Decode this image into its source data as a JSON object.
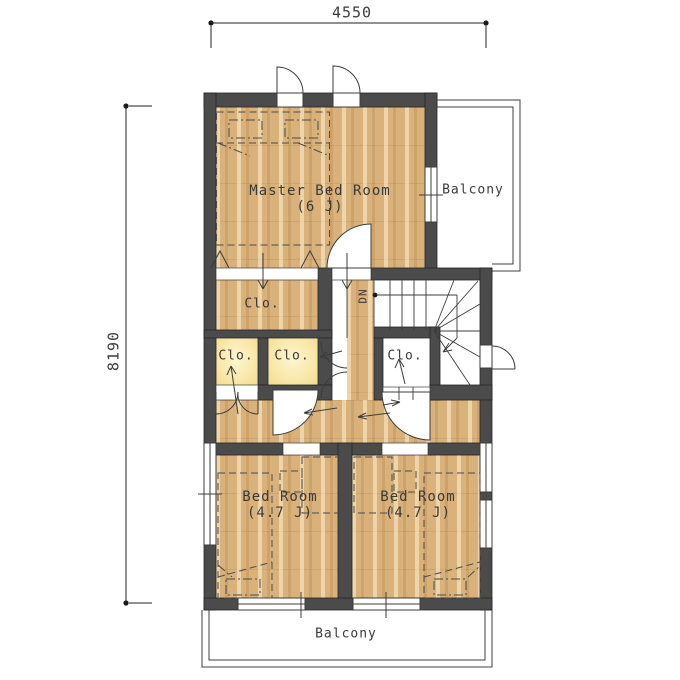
{
  "drawing": {
    "type": "second-floor-plan",
    "dimensions": {
      "width_mm": "4550",
      "height_mm": "8190"
    },
    "rooms": {
      "master_bedroom": {
        "name": "Master Bed Room",
        "size": "(6 J)"
      },
      "bedroom_left": {
        "name": "Bed Room",
        "size": "(4.7 J)"
      },
      "bedroom_right": {
        "name": "Bed Room",
        "size": "(4.7 J)"
      },
      "closet": {
        "name": "Clo."
      },
      "balcony": {
        "name": "Balcony"
      },
      "stairs": {
        "direction": "DN"
      }
    },
    "colors": {
      "wall": "#4b4b4b",
      "wood_floor": "#d9b17a",
      "closet_floor": "#f8e7a8",
      "paper": "#ffffff",
      "line": "#3c3c3c"
    }
  }
}
